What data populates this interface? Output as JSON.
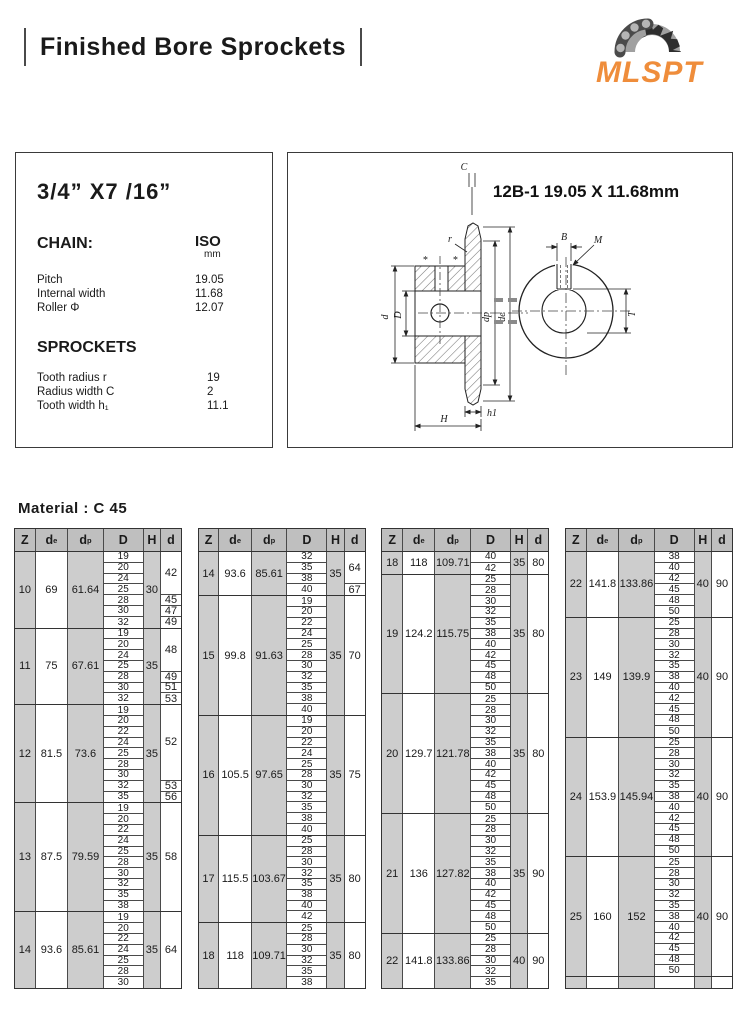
{
  "header": {
    "title": "Finished Bore Sprockets",
    "logo_text": "MLSPT",
    "logo_color": "#ef8d3b"
  },
  "spec_box": {
    "size_title": "3/4” X7 /16”",
    "chain_label": "CHAIN:",
    "unit_title": "ISO",
    "unit_sub": "mm",
    "chain_rows": [
      {
        "label": "Pitch",
        "value": "19.05"
      },
      {
        "label": "Internal width",
        "value": "11.68"
      },
      {
        "label": "Roller Φ",
        "value": "12.07"
      }
    ],
    "sprockets_label": "SPROCKETS",
    "sprocket_rows": [
      {
        "label": "Tooth radius r",
        "value": "19"
      },
      {
        "label": "Radius width C",
        "value": "2"
      },
      {
        "label": "Tooth width h₁",
        "value": "11.1"
      }
    ]
  },
  "drawing": {
    "title": "12B-1 19.05 X 11.68mm",
    "labels": {
      "c": "C",
      "r": "r",
      "d_shaft": "d",
      "d_bore": "D",
      "dp": "dp",
      "de": "de",
      "h1": "h1",
      "H": "H",
      "B": "B",
      "M": "M",
      "T": "T",
      "star": "*"
    }
  },
  "material_label": "Material : C 45",
  "table_headers": [
    {
      "main": "Z",
      "sub": ""
    },
    {
      "main": "d",
      "sub": "e"
    },
    {
      "main": "d",
      "sub": "p"
    },
    {
      "main": "D",
      "sub": ""
    },
    {
      "main": "H",
      "sub": ""
    },
    {
      "main": "d",
      "sub": ""
    }
  ],
  "tables": [
    {
      "groups": [
        {
          "z": "10",
          "de": "69",
          "dp": "61.64",
          "h": "30",
          "D": [
            "19",
            "20",
            "24",
            "25",
            "28",
            "30",
            "32"
          ],
          "d": [
            {
              "v": "42",
              "span": 4
            },
            {
              "v": "45",
              "span": 1
            },
            {
              "v": "47",
              "span": 1
            },
            {
              "v": "49",
              "span": 1
            }
          ]
        },
        {
          "z": "11",
          "de": "75",
          "dp": "67.61",
          "h": "35",
          "D": [
            "19",
            "20",
            "24",
            "25",
            "28",
            "30",
            "32"
          ],
          "d": [
            {
              "v": "48",
              "span": 4
            },
            {
              "v": "49",
              "span": 1
            },
            {
              "v": "51",
              "span": 1
            },
            {
              "v": "53",
              "span": 1
            }
          ]
        },
        {
          "z": "12",
          "de": "81.5",
          "dp": "73.6",
          "h": "35",
          "D": [
            "19",
            "20",
            "22",
            "24",
            "25",
            "28",
            "30",
            "32",
            "35"
          ],
          "d": [
            {
              "v": "52",
              "span": 7
            },
            {
              "v": "53",
              "span": 1
            },
            {
              "v": "56",
              "span": 1
            }
          ]
        },
        {
          "z": "13",
          "de": "87.5",
          "dp": "79.59",
          "h": "35",
          "D": [
            "19",
            "20",
            "22",
            "24",
            "25",
            "28",
            "30",
            "32",
            "35",
            "38"
          ],
          "d": [
            {
              "v": "58",
              "span": 10
            }
          ]
        },
        {
          "z": "14",
          "de": "93.6",
          "dp": "85.61",
          "h": "35",
          "D": [
            "19",
            "20",
            "22",
            "24",
            "25",
            "28",
            "30"
          ],
          "d": [
            {
              "v": "64",
              "span": 7
            }
          ]
        }
      ]
    },
    {
      "groups": [
        {
          "z": "14",
          "de": "93.6",
          "dp": "85.61",
          "h": "35",
          "D": [
            "32",
            "35",
            "38",
            "40"
          ],
          "d": [
            {
              "v": "64",
              "span": 3
            },
            {
              "v": "67",
              "span": 1
            }
          ]
        },
        {
          "z": "15",
          "de": "99.8",
          "dp": "91.63",
          "h": "35",
          "D": [
            "19",
            "20",
            "22",
            "24",
            "25",
            "28",
            "30",
            "32",
            "35",
            "38",
            "40"
          ],
          "d": [
            {
              "v": "70",
              "span": 11
            }
          ]
        },
        {
          "z": "16",
          "de": "105.5",
          "dp": "97.65",
          "h": "35",
          "D": [
            "19",
            "20",
            "22",
            "24",
            "25",
            "28",
            "30",
            "32",
            "35",
            "38",
            "40"
          ],
          "d": [
            {
              "v": "75",
              "span": 11
            }
          ]
        },
        {
          "z": "17",
          "de": "115.5",
          "dp": "103.67",
          "h": "35",
          "D": [
            "25",
            "28",
            "30",
            "32",
            "35",
            "38",
            "40",
            "42"
          ],
          "d": [
            {
              "v": "80",
              "span": 8
            }
          ]
        },
        {
          "z": "18",
          "de": "118",
          "dp": "109.71",
          "h": "35",
          "D": [
            "25",
            "28",
            "30",
            "32",
            "35",
            "38"
          ],
          "d": [
            {
              "v": "80",
              "span": 6
            }
          ]
        }
      ]
    },
    {
      "groups": [
        {
          "z": "18",
          "de": "118",
          "dp": "109.71",
          "h": "35",
          "D": [
            "40",
            "42"
          ],
          "d": [
            {
              "v": "80",
              "span": 2
            }
          ]
        },
        {
          "z": "19",
          "de": "124.2",
          "dp": "115.75",
          "h": "35",
          "D": [
            "25",
            "28",
            "30",
            "32",
            "35",
            "38",
            "40",
            "42",
            "45",
            "48",
            "50"
          ],
          "d": [
            {
              "v": "80",
              "span": 11
            }
          ]
        },
        {
          "z": "20",
          "de": "129.7",
          "dp": "121.78",
          "h": "35",
          "D": [
            "25",
            "28",
            "30",
            "32",
            "35",
            "38",
            "40",
            "42",
            "45",
            "48",
            "50"
          ],
          "d": [
            {
              "v": "80",
              "span": 11
            }
          ]
        },
        {
          "z": "21",
          "de": "136",
          "dp": "127.82",
          "h": "35",
          "D": [
            "25",
            "28",
            "30",
            "32",
            "35",
            "38",
            "40",
            "42",
            "45",
            "48",
            "50"
          ],
          "d": [
            {
              "v": "90",
              "span": 11
            }
          ]
        },
        {
          "z": "22",
          "de": "141.8",
          "dp": "133.86",
          "h": "40",
          "D": [
            "25",
            "28",
            "30",
            "32",
            "35"
          ],
          "d": [
            {
              "v": "90",
              "span": 5
            }
          ]
        }
      ]
    },
    {
      "groups": [
        {
          "z": "22",
          "de": "141.8",
          "dp": "133.86",
          "h": "40",
          "D": [
            "38",
            "40",
            "42",
            "45",
            "48",
            "50"
          ],
          "d": [
            {
              "v": "90",
              "span": 6
            }
          ]
        },
        {
          "z": "23",
          "de": "149",
          "dp": "139.9",
          "h": "40",
          "D": [
            "25",
            "28",
            "30",
            "32",
            "35",
            "38",
            "40",
            "42",
            "45",
            "48",
            "50"
          ],
          "d": [
            {
              "v": "90",
              "span": 11
            }
          ]
        },
        {
          "z": "24",
          "de": "153.9",
          "dp": "145.94",
          "h": "40",
          "D": [
            "25",
            "28",
            "30",
            "32",
            "35",
            "38",
            "40",
            "42",
            "45",
            "48",
            "50"
          ],
          "d": [
            {
              "v": "90",
              "span": 11
            }
          ]
        },
        {
          "z": "25",
          "de": "160",
          "dp": "152",
          "h": "40",
          "D": [
            "25",
            "28",
            "30",
            "32",
            "35",
            "38",
            "40",
            "42",
            "45",
            "48",
            "50"
          ],
          "d": [
            {
              "v": "90",
              "span": 11
            }
          ]
        },
        {
          "z": "",
          "de": "",
          "dp": "",
          "h": "",
          "D": [
            ""
          ],
          "d": [
            {
              "v": "",
              "span": 1
            }
          ]
        }
      ]
    }
  ]
}
